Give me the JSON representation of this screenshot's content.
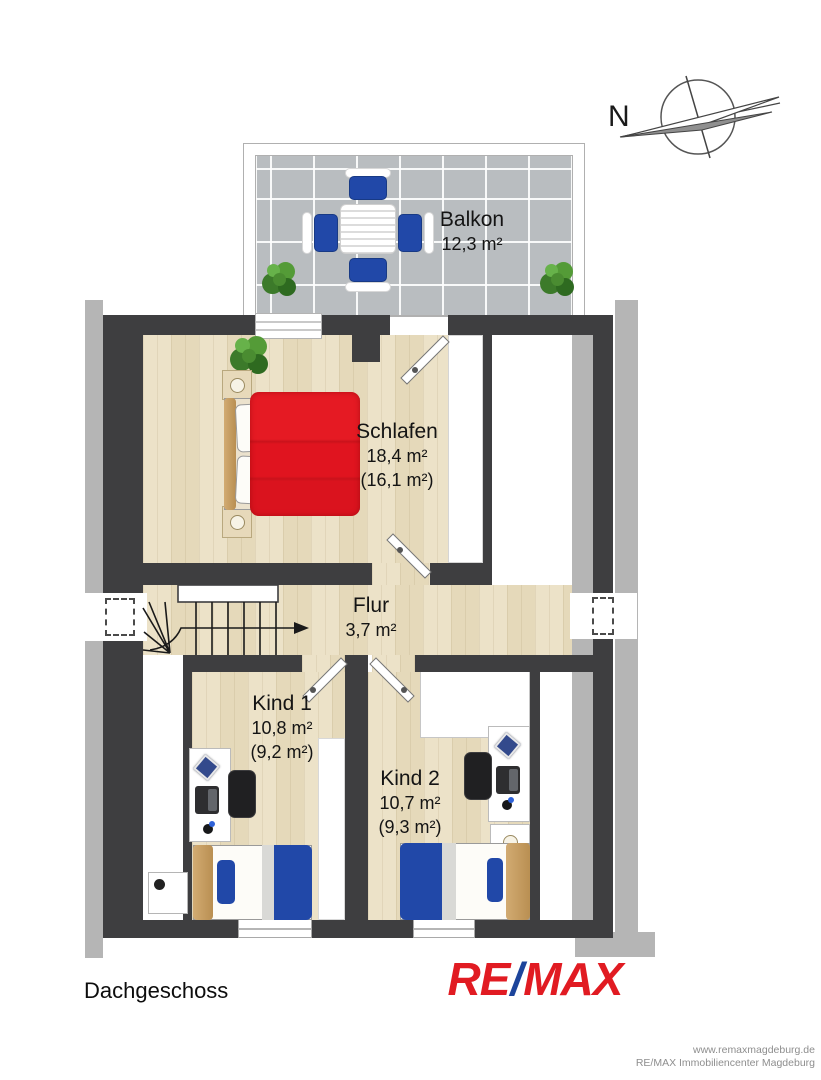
{
  "title": {
    "floor": "Dachgeschoss"
  },
  "compass": {
    "north_label": "N"
  },
  "rooms": [
    {
      "name": "Balkon",
      "area": "12,3 m²"
    },
    {
      "name": "Schlafen",
      "area": "18,4 m²",
      "area_reduced": "(16,1 m²)"
    },
    {
      "name": "Flur",
      "area": "3,7 m²"
    },
    {
      "name": "Kind 1",
      "area": "10,8 m²",
      "area_reduced": "(9,2 m²)"
    },
    {
      "name": "Kind 2",
      "area": "10,7 m²",
      "area_reduced": "(9,3 m²)"
    }
  ],
  "logo": {
    "re": "RE",
    "slash": "/",
    "max": "MAX",
    "red": "#e11b22",
    "blue": "#1c449b"
  },
  "footer": {
    "line1": "www.remaxmagdeburg.de",
    "line2": "RE/MAX Immobiliencenter Magdeburg"
  },
  "colors": {
    "wall": "#3e3e40",
    "roof_band": "#b5b5b5",
    "floor_wood": "#ece2c8",
    "balcony_tile": "#b9bdc0",
    "bed_red": "#e0141f",
    "furniture_blue": "#2148a8",
    "plant_green": "#3c7a2a"
  }
}
